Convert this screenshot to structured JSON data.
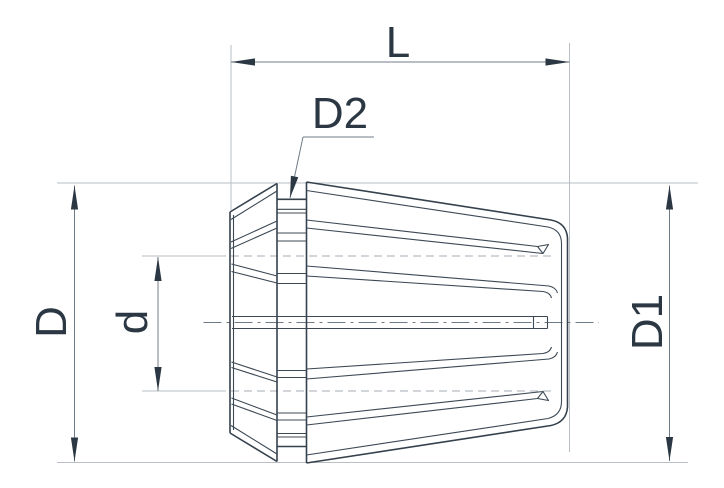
{
  "drawing": {
    "labels": {
      "L": "L",
      "D2": "D2",
      "D": "D",
      "d": "d",
      "D1": "D1"
    },
    "colors": {
      "outline": "#35414d",
      "inner": "#3c4854",
      "dimension": "#707c87",
      "extension": "#b9bfc5",
      "hidden": "#a6adb4",
      "centerline": "#6e7a85",
      "text": "#2b3743",
      "arrow": "#2b3743",
      "background": "#ffffff"
    }
  }
}
